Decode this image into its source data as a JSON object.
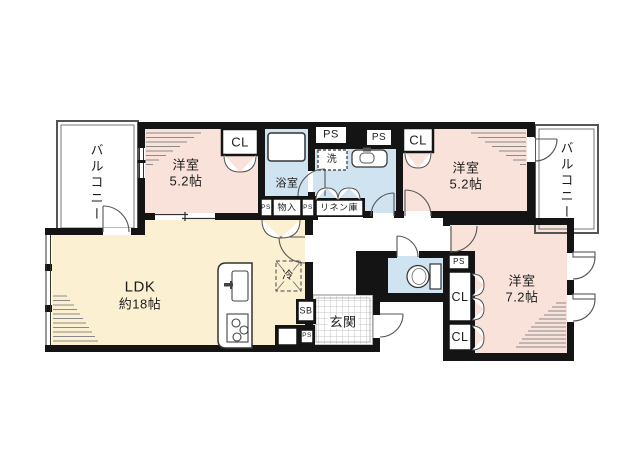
{
  "plan": {
    "rooms": {
      "ldk": {
        "name": "LDK",
        "size": "約18帖"
      },
      "bedroom_left": {
        "name": "洋室",
        "size": "5.2帖"
      },
      "bedroom_right": {
        "name": "洋室",
        "size": "5.2帖"
      },
      "bedroom_main": {
        "name": "洋室",
        "size": "7.2帖"
      },
      "bathroom": {
        "name": "浴室"
      },
      "entrance": {
        "name": "玄関"
      },
      "balcony_left": {
        "name": "バルコニー"
      },
      "balcony_right": {
        "name": "バルコニー"
      }
    },
    "fixtures": {
      "closet": "CL",
      "pipe_space": "PS",
      "washing_machine": "洗",
      "storage": "物入",
      "linen_closet": "リネン庫",
      "refrigerator": "冷",
      "shoe_box": "SB"
    },
    "colors": {
      "wall": "#141414",
      "western_room": "#f9e2da",
      "ldk": "#fcf0d2",
      "wet_area": "#cfe3f0",
      "background": "#ffffff"
    }
  }
}
